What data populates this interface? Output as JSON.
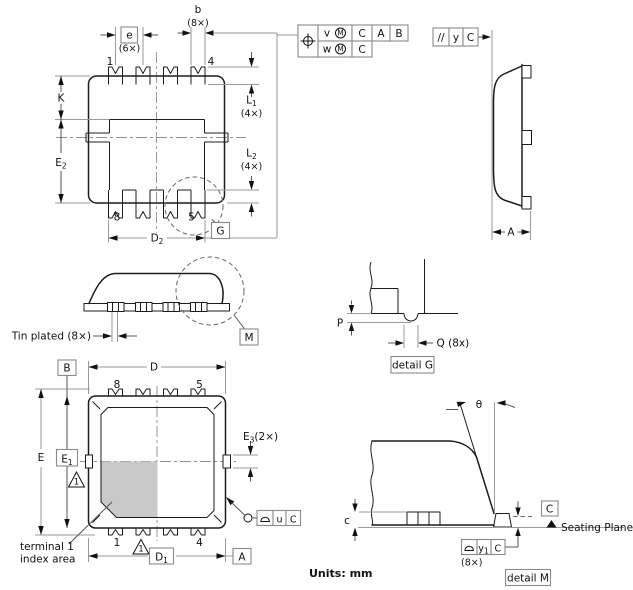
{
  "drawing": {
    "units_label": "Units: mm"
  },
  "top_view": {
    "dim_b": {
      "label": "b",
      "count": "(8×)"
    },
    "dim_e": {
      "label": "e",
      "count": "(6×)"
    },
    "dim_K": {
      "label": "K"
    },
    "dim_E2": {
      "base": "E",
      "sub": "2"
    },
    "dim_L1": {
      "base": "L",
      "sub": "1",
      "count": "(4×)"
    },
    "dim_L2": {
      "base": "L",
      "sub": "2",
      "count": "(4×)"
    },
    "dim_D2": {
      "base": "D",
      "sub": "2"
    },
    "pin_top_left": "1",
    "pin_top_right": "4",
    "pin_bottom_left": "8",
    "pin_bottom_right": "5",
    "detail_ref_G": "G"
  },
  "position_frame": {
    "symbol": "position-crosshair",
    "row1": {
      "tolerance": "v",
      "modifier": "M",
      "datum1": "C",
      "datum2": "A",
      "datum3": "B"
    },
    "row2": {
      "tolerance": "w",
      "modifier": "M",
      "datum1": "C"
    }
  },
  "parallelism_frame": {
    "symbol": "//",
    "tolerance": "y",
    "datum": "C"
  },
  "side_view": {
    "dim_A": "A"
  },
  "front_view": {
    "tin_plated_label": "Tin plated (8×)",
    "detail_ref_M": "M"
  },
  "detail_g": {
    "dim_P": "P",
    "dim_Q": "Q (8x)",
    "title": "detail G"
  },
  "bottom_view": {
    "datum_B": "B",
    "datum_A": "A",
    "dim_D": "D",
    "dim_E": "E",
    "dim_E1": {
      "base": "E",
      "sub": "1"
    },
    "dim_D1": {
      "base": "D",
      "sub": "1"
    },
    "dim_E3": {
      "base": "E",
      "sub": "3",
      "count": "(2×)"
    },
    "pin_top_left": "8",
    "pin_top_right": "5",
    "pin_bottom_left": "1",
    "pin_bottom_right": "4",
    "note_triangle_label": "1",
    "coplanarity_frame": {
      "symbol": "semicircle",
      "tolerance": "u",
      "datum": "C"
    },
    "index_label_line1": "terminal 1",
    "index_label_line2": "index area"
  },
  "detail_m": {
    "dim_theta": "θ",
    "dim_c": "c",
    "coplanarity_frame": {
      "symbol": "semicircle",
      "tolerance_base": "y",
      "tolerance_sub": "1",
      "datum": "C",
      "count": "(8×)"
    },
    "datum_C": "C",
    "seating_plane_label": "Seating Plane",
    "title": "detail M"
  },
  "colors": {
    "object_line": "#1c1c1c",
    "dimension_line": "#9a9a9a",
    "index_area_fill": "#c9c9c9",
    "background": "#ffffff"
  }
}
